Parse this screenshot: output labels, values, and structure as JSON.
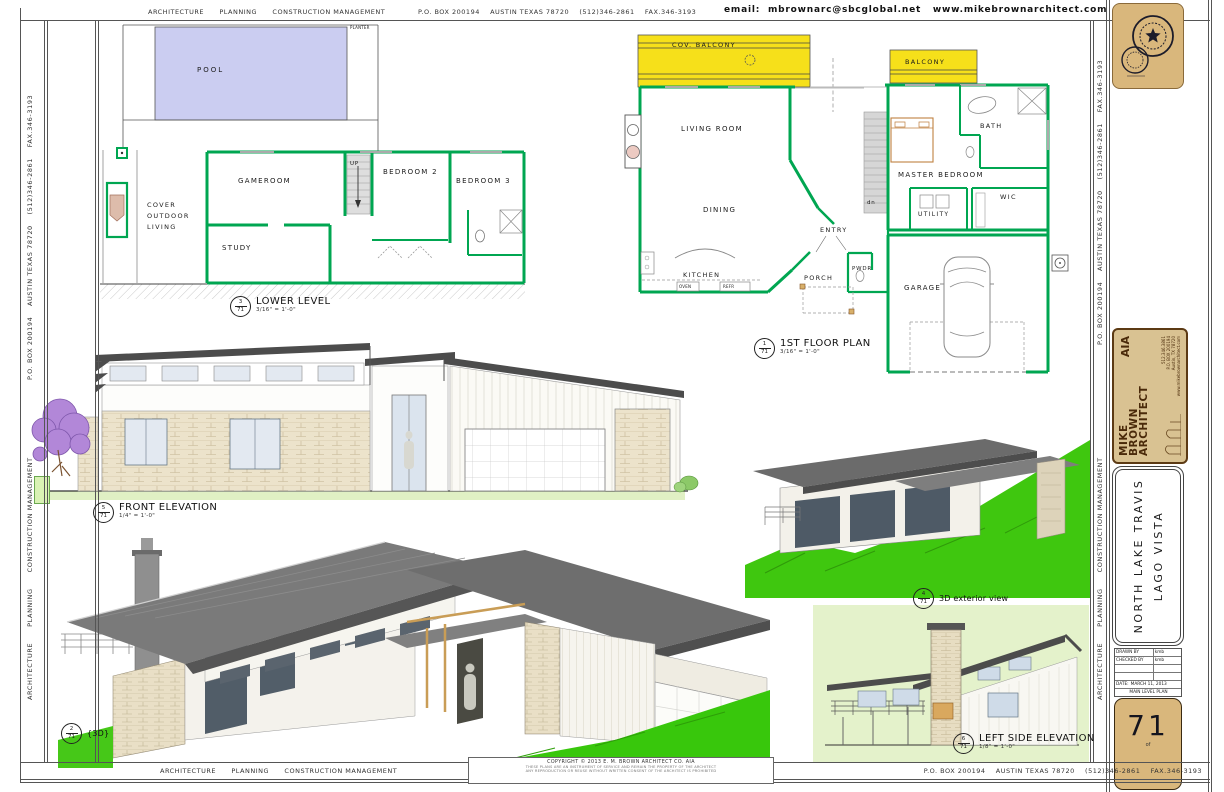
{
  "edges": {
    "firm": "ARCHITECTURE      PLANNING      CONSTRUCTION MANAGEMENT",
    "address": "P.O. BOX 200194    AUSTIN TEXAS 78720    (512)346-2861    FAX.346-3193",
    "email": "email:  mbrownarc@sbcglobal.net   www.mikebrownarchitect.com",
    "copyright_title": "COPYRIGHT © 2013 E. M. BROWN ARCHITECT CO. AIA",
    "copyright_small1": "THESE PLANS ARE AN INSTRUMENT OF SERVICE AND REMAIN THE PROPERTY OF THE ARCHITECT",
    "copyright_small2": "ANY REPRODUCTION OR REUSE WITHOUT WRITTEN CONSENT OF THE ARCHITECT IS PROHIBITED"
  },
  "views": {
    "lower_level": {
      "num": "3",
      "den": "71",
      "title": "LOWER LEVEL",
      "scale": "3/16\" = 1'-0\""
    },
    "first_floor": {
      "num": "1",
      "den": "71",
      "title": "1ST FLOOR PLAN",
      "scale": "3/16\" = 1'-0\""
    },
    "front_elevation": {
      "num": "5",
      "den": "71",
      "title": "FRONT ELEVATION",
      "scale": "1/4\" = 1'-0\""
    },
    "exterior_3d": {
      "num": "4",
      "den": "71",
      "title": "3D exterior view",
      "scale": ""
    },
    "big_3d": {
      "num": "2",
      "den": "71",
      "title": "{3D}",
      "scale": ""
    },
    "left_side_elevation": {
      "num": "6",
      "den": "71",
      "title": "LEFT SIDE ELEVATION",
      "scale": "1/8\" = 1'-0\""
    }
  },
  "lower_level_rooms": {
    "pool": "POOL",
    "planter": "PLANTER",
    "cover_outdoor": "COVER OUTDOOR LIVING",
    "gameroom": "GAMEROOM",
    "study": "STUDY",
    "bedroom2": "BEDROOM 2",
    "bedroom3": "BEDROOM 3",
    "up": "UP"
  },
  "first_floor_rooms": {
    "cov_balcony": "COV. BALCONY",
    "balcony": "BALCONY",
    "living": "LIVING ROOM",
    "dining": "DINING",
    "kitchen": "KITCHEN",
    "oven": "OVEN",
    "refr": "REFR",
    "entry": "ENTRY",
    "porch": "PORCH",
    "pwdr": "PWDR",
    "master": "MASTER BEDROOM",
    "bath": "BATH",
    "wic": "WIC",
    "utility": "UTILITY",
    "garage": "GARAGE",
    "dn": "dn"
  },
  "title_block": {
    "logo_line1": "MIKE",
    "logo_line2": "BROWN",
    "logo_line3": "ARCHITECT",
    "logo_aia": "AIA",
    "logo_phone": "512.346.3861",
    "logo_po": "P.O. BOX 200194",
    "logo_city": "Austin, TX 78720",
    "logo_web": "www.mikebrownarchitect.com",
    "project_line1": "NORTH LAKE TRAVIS",
    "project_line2": "LAGO VISTA",
    "drawn_by_label": "DRAWN BY",
    "drawn_by": "kmb",
    "checked_by_label": "CHECKED BY",
    "checked_by": "kmb",
    "date_label": "DATE:",
    "date": "MARCH 11, 2013",
    "plan_title": "MAIN LEVEL PLAN",
    "sheet_number": "71",
    "sheet_of": "of"
  },
  "colors": {
    "wall_green": "#00a651",
    "pool": "#cbcdf1",
    "balcony_yellow": "#f6e01a",
    "grass": "#3cc70e",
    "pale_green": "#e4f2cb",
    "roof_gray": "#7a7a7a",
    "stone": "#ece3cb",
    "seal_tan": "#d9b77c",
    "logo_tan": "#d9c292",
    "tree_purple": "#b287d8"
  }
}
